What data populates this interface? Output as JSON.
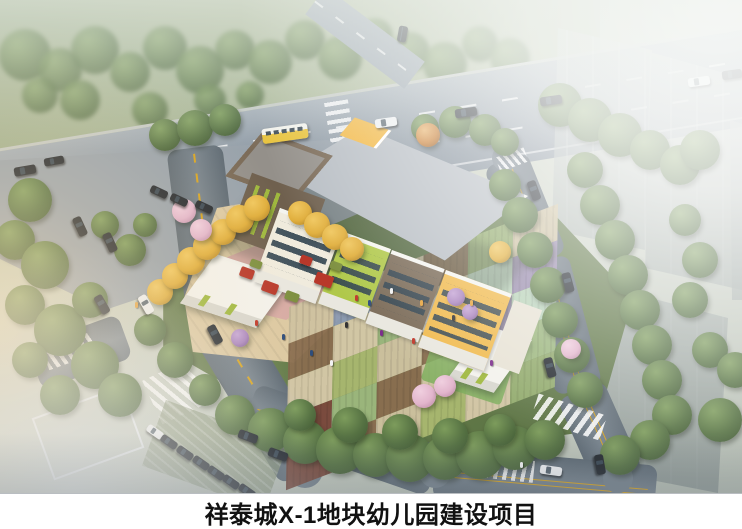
{
  "caption": {
    "text": "祥泰城X-1地块幼儿园建设项目"
  },
  "palette": {
    "caption_bg": "#ffffff",
    "caption_text": "#111111",
    "road_main": "#96a1ab",
    "road_side_dark": "#5e6a74",
    "road_side_light": "#76828c",
    "apron_gray": "#98a2ab",
    "lane_marking_white": "#ffffff",
    "center_line_yellow": "#d9a520",
    "park_green": "#a3b292",
    "tree_green_dark": "#3f5732",
    "tree_green": "#567243",
    "tree_green_light": "#7d9c5c",
    "tree_autumn_yellow": "#e0ae3c",
    "tree_autumn_orange": "#c97f35",
    "tree_blossom_pink": "#e2b5cc",
    "shrub_lilac": "#ab86bf",
    "site_green": "#6d8551",
    "plaza_tan": "#dcc9a2",
    "playground_pink": "#d7aba4",
    "equipment_red": "#b8382a",
    "equipment_green": "#7d8f3f",
    "building_roof_gray": "#b7bdc3",
    "building_parapet_white": "#f4f4ef",
    "facade_cream": "#f0ebdd",
    "facade_lime": "#b0c84a",
    "facade_brown": "#7b6b58",
    "facade_yellow": "#f0ba4e",
    "facade_window_dark": "#31434f",
    "cube_brown": "#6f604e",
    "cube_roof": "#94908a",
    "cube_window_green": "#9fb83e",
    "roof_accent_yellow": "#f2b63f",
    "gatehouse_white": "#f3f2ec",
    "gatehouse_shadow": "#d8d7cf",
    "tower_gray_light": "#c6cecb",
    "tower_gray_dark": "#8c968f",
    "glass_canopy": "#aebfcb",
    "lawn_green": "#7fae5e",
    "car_dark": "#23282e",
    "car_white": "#eef0f2",
    "bus_yellow": "#e8c23a",
    "fog_white": "#ffffff",
    "sun_glow": "#ffe4b9"
  },
  "building": {
    "facade_sections": [
      "#f0ebdd",
      "#b0c84a",
      "#7b6b58",
      "#f0ba4e"
    ]
  },
  "courtyard": {
    "rows": 5,
    "cols": 6,
    "tile_colors": [
      [
        "#cfc2a0",
        "#8d9bb3",
        "#d6c9a8",
        "#8a6e50",
        "#94ad6e",
        "#cfc2a0"
      ],
      [
        "#8a6e50",
        "#d6c9a8",
        "#9db87e",
        "#cfc2a0",
        "#bcd6bd",
        "#9a8bb0"
      ],
      [
        "#d6c9a8",
        "#a9b870",
        "#cfc2a0",
        "#8a6e50",
        "#8a7f9e",
        "#bcd6bd"
      ],
      [
        "#7b4a3c",
        "#9db87e",
        "#8a6e50",
        "#d6c9a8",
        "#b9a8c9",
        "#9db87e"
      ],
      [
        "#7b4a3c",
        "#8a6e50",
        "#cfc2a0",
        "#a9b870",
        "#d6c9a8",
        "#94ad6e"
      ]
    ]
  }
}
